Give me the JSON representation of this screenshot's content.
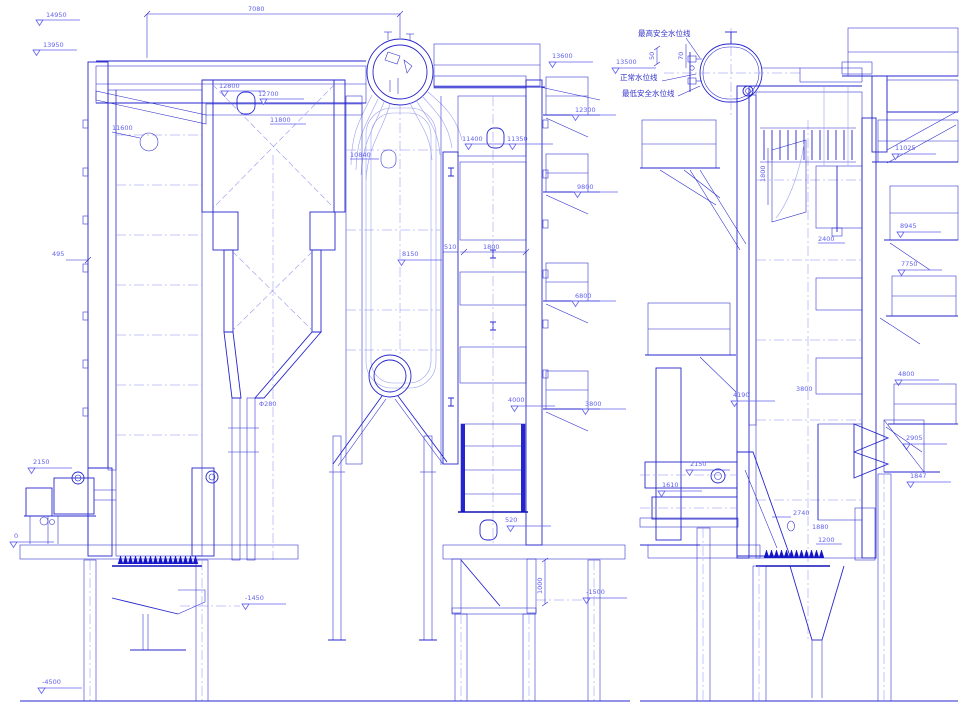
{
  "meta": {
    "drawing": "boiler sectional arrangement, two elevation views",
    "background": "#ffffff"
  },
  "colors": {
    "line": "#2626cc",
    "line_light": "#9aa2ee",
    "line_dark": "#0f0fbe",
    "text_dim": "#6262ee",
    "text_cjk": "#3030cc",
    "background": "#ffffff"
  },
  "annotations": {
    "top_dims": {
      "overall_width": "7080"
    },
    "front_left_elevations": [
      "14950",
      "13950"
    ],
    "front_left_dims": [
      "495",
      "2150",
      "0"
    ],
    "front_bottom": [
      "-1450",
      "-4500",
      "-1500",
      "1000"
    ],
    "front_interior": [
      "12800",
      "12700",
      "11800",
      "11600",
      "10840",
      "11400",
      "11350",
      "8150",
      "510",
      "1800",
      "4000",
      "520",
      "Φ280"
    ],
    "front_right_elevations": [
      "13600",
      "12300",
      "9800",
      "6800",
      "3800"
    ],
    "water_level": {
      "highest": "最高安全水位线",
      "normal": "正常水位线",
      "lowest": "最低安全水位线",
      "drum_elevation": "13500",
      "dim_small_a": "50",
      "dim_small_b": "70"
    },
    "side_right_elevations": [
      "11025",
      "8945",
      "7750",
      "4800",
      "2905",
      "1847"
    ],
    "side_interior": [
      "1800",
      "2400",
      "4190",
      "3800",
      "2150",
      "1610",
      "2740",
      "1880",
      "1200"
    ]
  }
}
